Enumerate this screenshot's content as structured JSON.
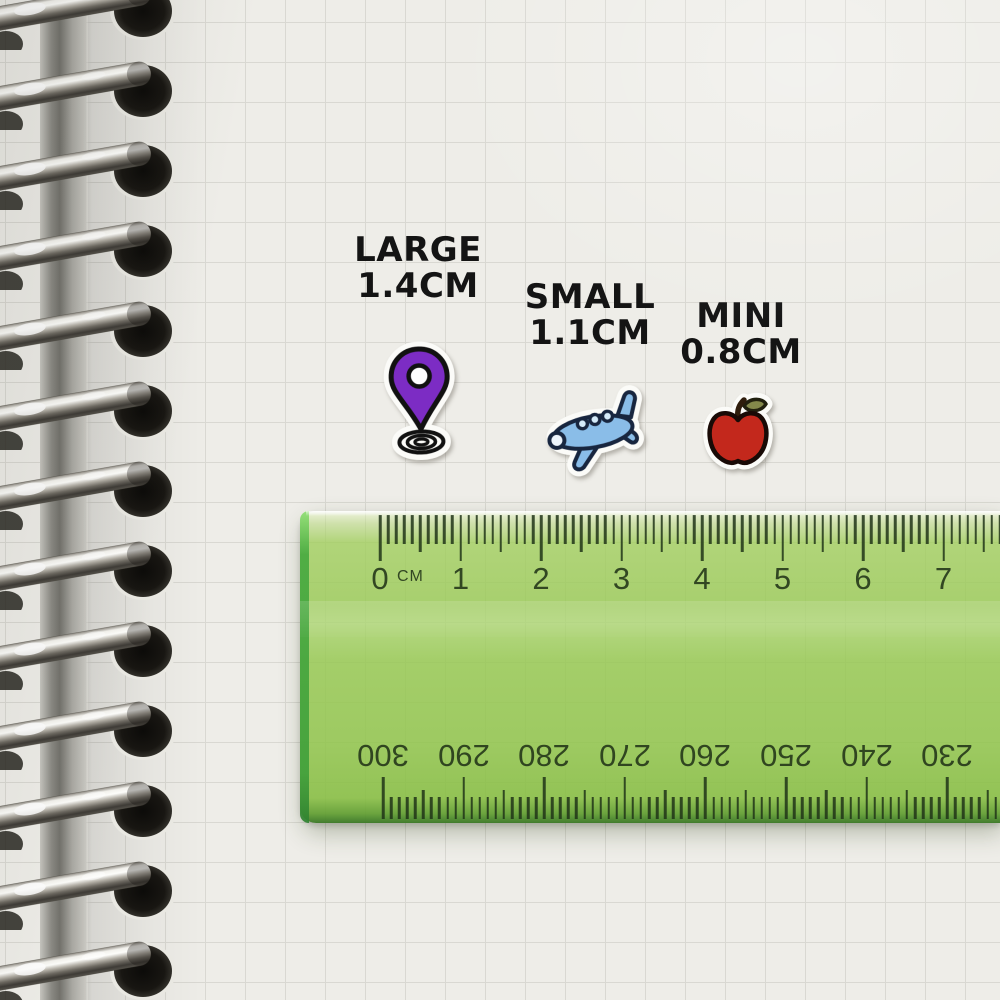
{
  "size_labels": [
    {
      "id": "large",
      "name": "LARGE",
      "size": "1.4CM"
    },
    {
      "id": "small",
      "name": "SMALL",
      "size": "1.1CM"
    },
    {
      "id": "mini",
      "name": "MINI",
      "size": "0.8CM"
    }
  ],
  "stickers": [
    {
      "id": "location-pin",
      "color": "#7c2cc4"
    },
    {
      "id": "airplane",
      "color": "#8abde8"
    },
    {
      "id": "apple",
      "color": "#c3281c"
    }
  ],
  "ruler": {
    "unit_label": "CM",
    "top_numbers": [
      "0",
      "1",
      "2",
      "3",
      "4",
      "5",
      "6",
      "7"
    ],
    "bottom_numbers": [
      "300",
      "290",
      "280",
      "270",
      "260",
      "250",
      "240",
      "230"
    ],
    "body_color": "#96c951",
    "edge_color": "#41a03b",
    "tick_color": "#203418"
  },
  "notebook": {
    "ring_count": 13,
    "paper_color": "#eeede8",
    "grid_color": "#d9d8d2",
    "label_text_color": "#141414"
  }
}
